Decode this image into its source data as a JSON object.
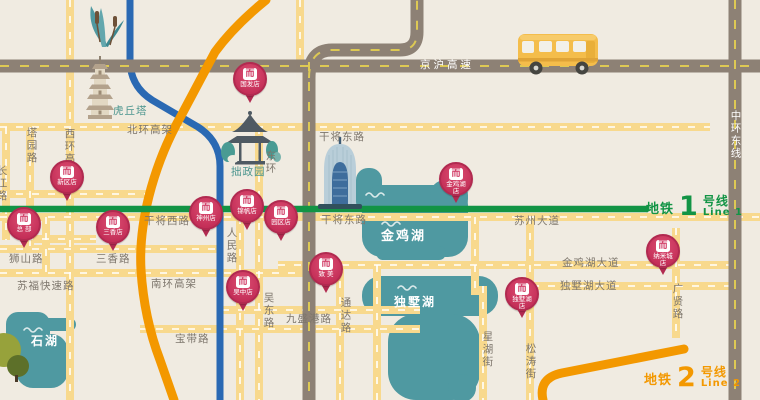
{
  "map_name": "suzhou-store-locations-map",
  "colors": {
    "background": "#f0ebe1",
    "road": "#f8d98d",
    "highway": "#8d8175",
    "highway_dash": "#ddc954",
    "canal": "#2a69b3",
    "metro_line1": "#129445",
    "metro_line2": "#f39800",
    "lake": "#4f99a1",
    "pin": "#c9355e",
    "pin_dark": "#b12a50",
    "label": "#7d766c",
    "landmark_label": "#49948d"
  },
  "brand_glyph": "而",
  "legend_line1": {
    "prefix": "地铁",
    "number": "1",
    "suffix": "号线",
    "sub": "Line 1"
  },
  "legend_line2": {
    "prefix": "地铁",
    "number": "2",
    "suffix": "号线",
    "sub": "Line 2"
  },
  "labels": [
    {
      "t": "北环高架",
      "x": 127,
      "y": 125
    },
    {
      "t": "干将东路",
      "x": 319,
      "y": 132
    },
    {
      "t": "虎丘塔",
      "x": 113,
      "y": 106,
      "c": "teal"
    },
    {
      "t": "拙政园",
      "x": 231,
      "y": 167,
      "c": "teal"
    },
    {
      "t": "塔园路",
      "x": 25,
      "y": 127,
      "v": 1
    },
    {
      "t": "西环高架",
      "x": 63,
      "y": 128,
      "v": 1
    },
    {
      "t": "长江路",
      "x": -5,
      "y": 165,
      "v": 1
    },
    {
      "t": "东环",
      "x": 264,
      "y": 150,
      "v": 1
    },
    {
      "t": "干将西路",
      "x": 144,
      "y": 216
    },
    {
      "t": "干将东路",
      "x": 321,
      "y": 215
    },
    {
      "t": "苏州大道",
      "x": 514,
      "y": 216
    },
    {
      "t": "狮山路",
      "x": 9,
      "y": 254
    },
    {
      "t": "三香路",
      "x": 96,
      "y": 254
    },
    {
      "t": "苏福快速路",
      "x": 17,
      "y": 281
    },
    {
      "t": "南环高架",
      "x": 151,
      "y": 279
    },
    {
      "t": "宝带路",
      "x": 175,
      "y": 334
    },
    {
      "t": "九盛港路",
      "x": 286,
      "y": 314
    },
    {
      "t": "人民路",
      "x": 225,
      "y": 227,
      "v": 1
    },
    {
      "t": "吴东路",
      "x": 262,
      "y": 292,
      "v": 1
    },
    {
      "t": "通达路",
      "x": 339,
      "y": 297,
      "v": 1
    },
    {
      "t": "金鸡湖大道",
      "x": 562,
      "y": 258
    },
    {
      "t": "独墅湖大道",
      "x": 560,
      "y": 281
    },
    {
      "t": "广贤路",
      "x": 671,
      "y": 283,
      "v": 1
    },
    {
      "t": "星湖街",
      "x": 481,
      "y": 331,
      "v": 1
    },
    {
      "t": "松涛街",
      "x": 524,
      "y": 343,
      "v": 1
    },
    {
      "t": "京沪高速",
      "x": 420,
      "y": 60,
      "c": "white",
      "ls": 3
    },
    {
      "t": "中环东线",
      "x": 729,
      "y": 110,
      "v": 1,
      "c": "white"
    },
    {
      "t": "金鸡湖",
      "x": 381,
      "y": 230,
      "c": "lake"
    },
    {
      "t": "独墅湖",
      "x": 394,
      "y": 296,
      "c": "lake",
      "fs": 12
    },
    {
      "t": "石湖",
      "x": 31,
      "y": 335,
      "c": "lake",
      "fs": 12
    }
  ],
  "pins": [
    {
      "t": "新区店",
      "x": 67,
      "y": 177
    },
    {
      "t": "总 部",
      "x": 24,
      "y": 224
    },
    {
      "t": "三香店",
      "x": 113,
      "y": 227
    },
    {
      "t": "国发店",
      "x": 250,
      "y": 79
    },
    {
      "t": "神州店",
      "x": 206,
      "y": 213
    },
    {
      "t": "锦帆店",
      "x": 247,
      "y": 206
    },
    {
      "t": "园区店",
      "x": 281,
      "y": 217
    },
    {
      "t": "吴中店",
      "x": 243,
      "y": 287
    },
    {
      "t": "致 美",
      "x": 326,
      "y": 269
    },
    {
      "t": "金鸡湖店",
      "x": 456,
      "y": 179
    },
    {
      "t": "纳米城店",
      "x": 663,
      "y": 251
    },
    {
      "t": "独墅湖店",
      "x": 522,
      "y": 294
    }
  ],
  "landmark_icons": [
    "pagoda-icon",
    "pavilion-icon",
    "gate-of-east-icon",
    "bus-icon",
    "reeds-icon",
    "hill-icon",
    "brand-logo-icon"
  ]
}
